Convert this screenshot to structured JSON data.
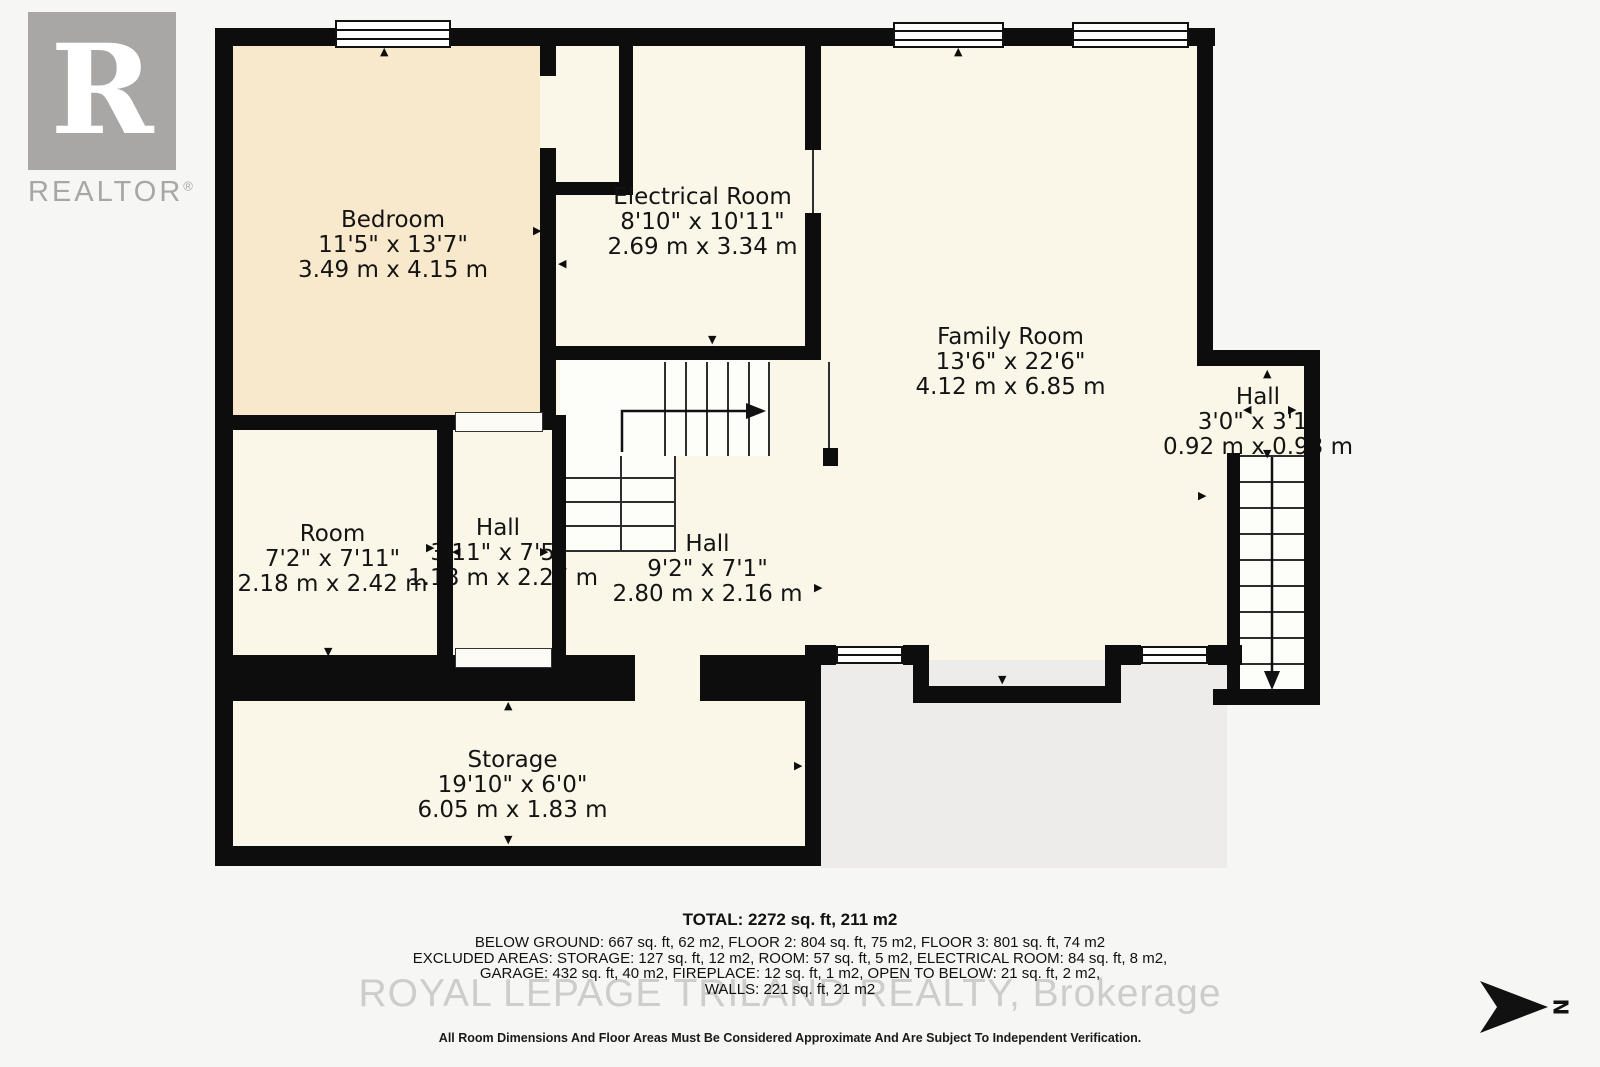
{
  "branding": {
    "logo_letter": "R",
    "logo_text": "REALTOR",
    "registered_mark": "®"
  },
  "watermark": {
    "text": "ROYAL LEPAGE TRILAND REALTY, Brokerage"
  },
  "rooms": [
    {
      "name": "Bedroom",
      "imperial": "11'5\" x 13'7\"",
      "metric": "3.49 m x 4.15 m"
    },
    {
      "name": "Electrical Room",
      "imperial": "8'10\" x 10'11\"",
      "metric": "2.69 m x 3.34 m"
    },
    {
      "name": "Family Room",
      "imperial": "13'6\" x 22'6\"",
      "metric": "4.12 m x 6.85 m"
    },
    {
      "name": "Hall",
      "imperial": "3'0\" x 3'1\"",
      "metric": "0.92 m x 0.93 m"
    },
    {
      "name": "Room",
      "imperial": "7'2\" x 7'11\"",
      "metric": "2.18 m x 2.42 m"
    },
    {
      "name": "Hall",
      "imperial": "3'11\" x 7'5\"",
      "metric": "1.18 m x 2.27 m"
    },
    {
      "name": "Hall",
      "imperial": "9'2\" x 7'1\"",
      "metric": "2.80 m x 2.16 m"
    },
    {
      "name": "Storage",
      "imperial": "19'10\" x 6'0\"",
      "metric": "6.05 m x 1.83 m"
    }
  ],
  "summary": {
    "total": "TOTAL: 2272 sq. ft, 211 m2",
    "line2": "BELOW GROUND: 667 sq. ft, 62 m2, FLOOR 2: 804 sq. ft, 75 m2, FLOOR 3: 801 sq. ft, 74 m2",
    "line3": "EXCLUDED AREAS: STORAGE: 127 sq. ft, 12 m2, ROOM: 57 sq. ft, 5 m2, ELECTRICAL ROOM: 84 sq. ft, 8 m2,",
    "line4": "GARAGE: 432 sq. ft, 40 m2, FIREPLACE: 12 sq. ft, 1 m2, OPEN TO BELOW: 21 sq. ft, 2 m2,",
    "line5": "WALLS: 221 sq. ft, 21 m2",
    "disclaimer": "All Room Dimensions And Floor Areas Must Be Considered Approximate And Are Subject To Independent Verification."
  },
  "compass": {
    "label": "N"
  },
  "icons": {
    "up": "▲",
    "down": "▼",
    "left": "◀",
    "right": "▶"
  },
  "colors": {
    "wall": "#0d0d0d",
    "bedroom_fill": "#f9e9cc",
    "room_fill": "#faf7e9",
    "stair_fill": "#fdfdfa",
    "logo_gray": "#a9a7a5"
  }
}
